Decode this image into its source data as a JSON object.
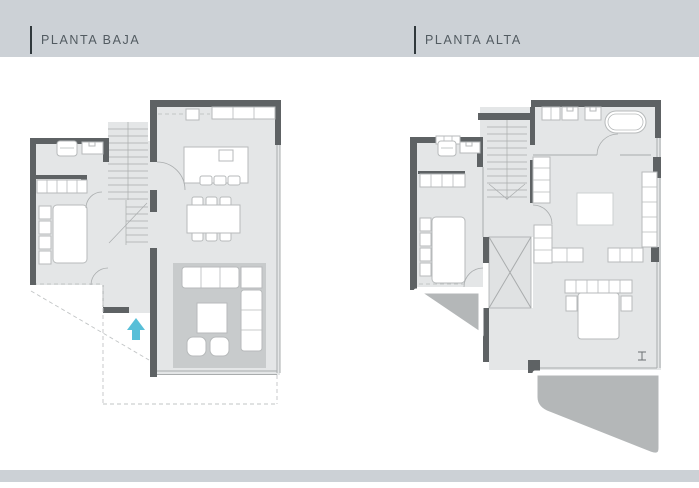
{
  "plans": [
    {
      "id": "planta-baja",
      "label": "PLANTA BAJA"
    },
    {
      "id": "planta-alta",
      "label": "PLANTA ALTA"
    }
  ],
  "icons": {
    "entrance_arrow": "triangle-up",
    "section_marker": "I-beam"
  },
  "colors": {
    "band": "#ccd1d6",
    "label_text": "#525b61",
    "label_bar": "#30383c",
    "wall": "#5e6264",
    "floor": "#e4e6e7",
    "floor_alt": "#e0e2e3",
    "rug": "#c8cbcc",
    "terrace": "#b4b7b8",
    "furn_fill": "#ffffff",
    "furn_stroke": "#b7babb",
    "line": "#a9acad",
    "dash": "#c2c5c6",
    "accent_arrow": "#58bfd8",
    "marker": "#6b7073"
  }
}
